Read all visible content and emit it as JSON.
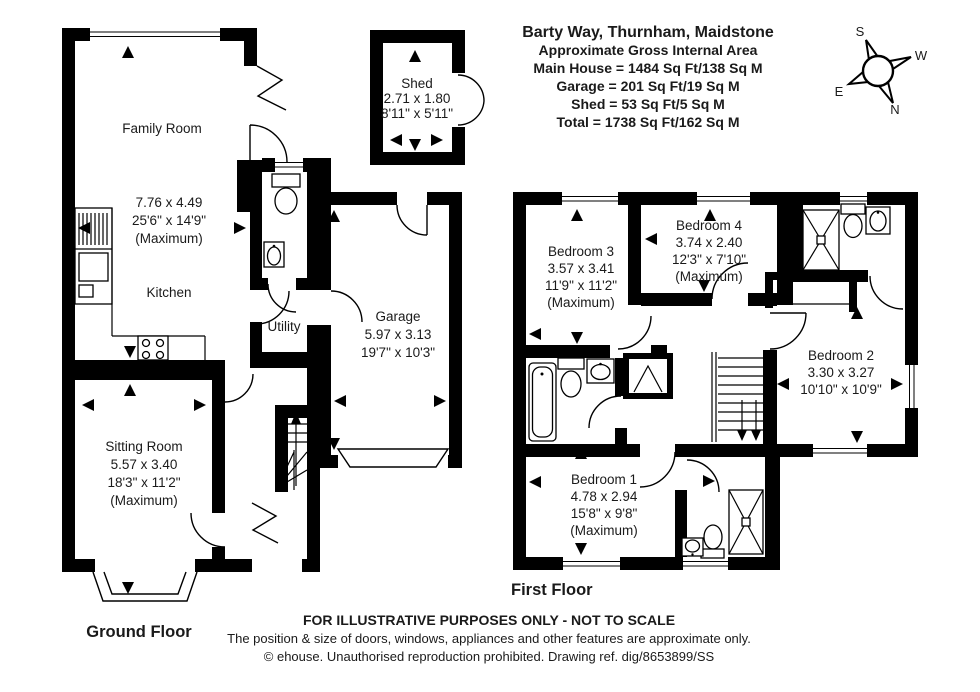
{
  "title_block": {
    "line1": "Barty Way, Thurnham, Maidstone",
    "line2": "Approximate Gross Internal Area",
    "line3": "Main House = 1484 Sq Ft/138 Sq M",
    "line4": "Garage = 201 Sq Ft/19 Sq M",
    "line5": "Shed = 53 Sq Ft/5 Sq M",
    "line6": "Total = 1738 Sq Ft/162 Sq M"
  },
  "compass": {
    "north": "N",
    "south": "S",
    "east": "E",
    "west": "W"
  },
  "ground_floor": {
    "label": "Ground Floor",
    "family_room": {
      "name": "Family Room",
      "metric": "7.76 x 4.49",
      "imperial": "25'6\" x 14'9\"",
      "note": "(Maximum)"
    },
    "kitchen": {
      "name": "Kitchen"
    },
    "utility": {
      "name": "Utility"
    },
    "sitting_room": {
      "name": "Sitting Room",
      "metric": "5.57 x 3.40",
      "imperial": "18'3\" x 11'2\"",
      "note": "(Maximum)"
    },
    "garage": {
      "name": "Garage",
      "metric": "5.97 x 3.13",
      "imperial": "19'7\" x 10'3\""
    }
  },
  "shed": {
    "name": "Shed",
    "metric": "2.71 x 1.80",
    "imperial": "8'11\" x 5'11\""
  },
  "first_floor": {
    "label": "First Floor",
    "bedroom1": {
      "name": "Bedroom 1",
      "metric": "4.78 x 2.94",
      "imperial": "15'8\" x 9'8\"",
      "note": "(Maximum)"
    },
    "bedroom2": {
      "name": "Bedroom 2",
      "metric": "3.30 x 3.27",
      "imperial": "10'10\" x 10'9\""
    },
    "bedroom3": {
      "name": "Bedroom 3",
      "metric": "3.57 x 3.41",
      "imperial": "11'9\" x 11'2\"",
      "note": "(Maximum)"
    },
    "bedroom4": {
      "name": "Bedroom 4",
      "metric": "3.74 x 2.40",
      "imperial": "12'3\" x 7'10\"",
      "note": "(Maximum)"
    }
  },
  "footer": {
    "line1": "FOR ILLUSTRATIVE PURPOSES ONLY - NOT TO SCALE",
    "line2": "The position & size of doors, windows, appliances and other features are approximate only.",
    "line3": "© ehouse. Unauthorised reproduction prohibited. Drawing ref. dig/8653899/SS"
  },
  "colors": {
    "walls": "#000000",
    "background": "#ffffff",
    "text": "#1a1a1a"
  }
}
